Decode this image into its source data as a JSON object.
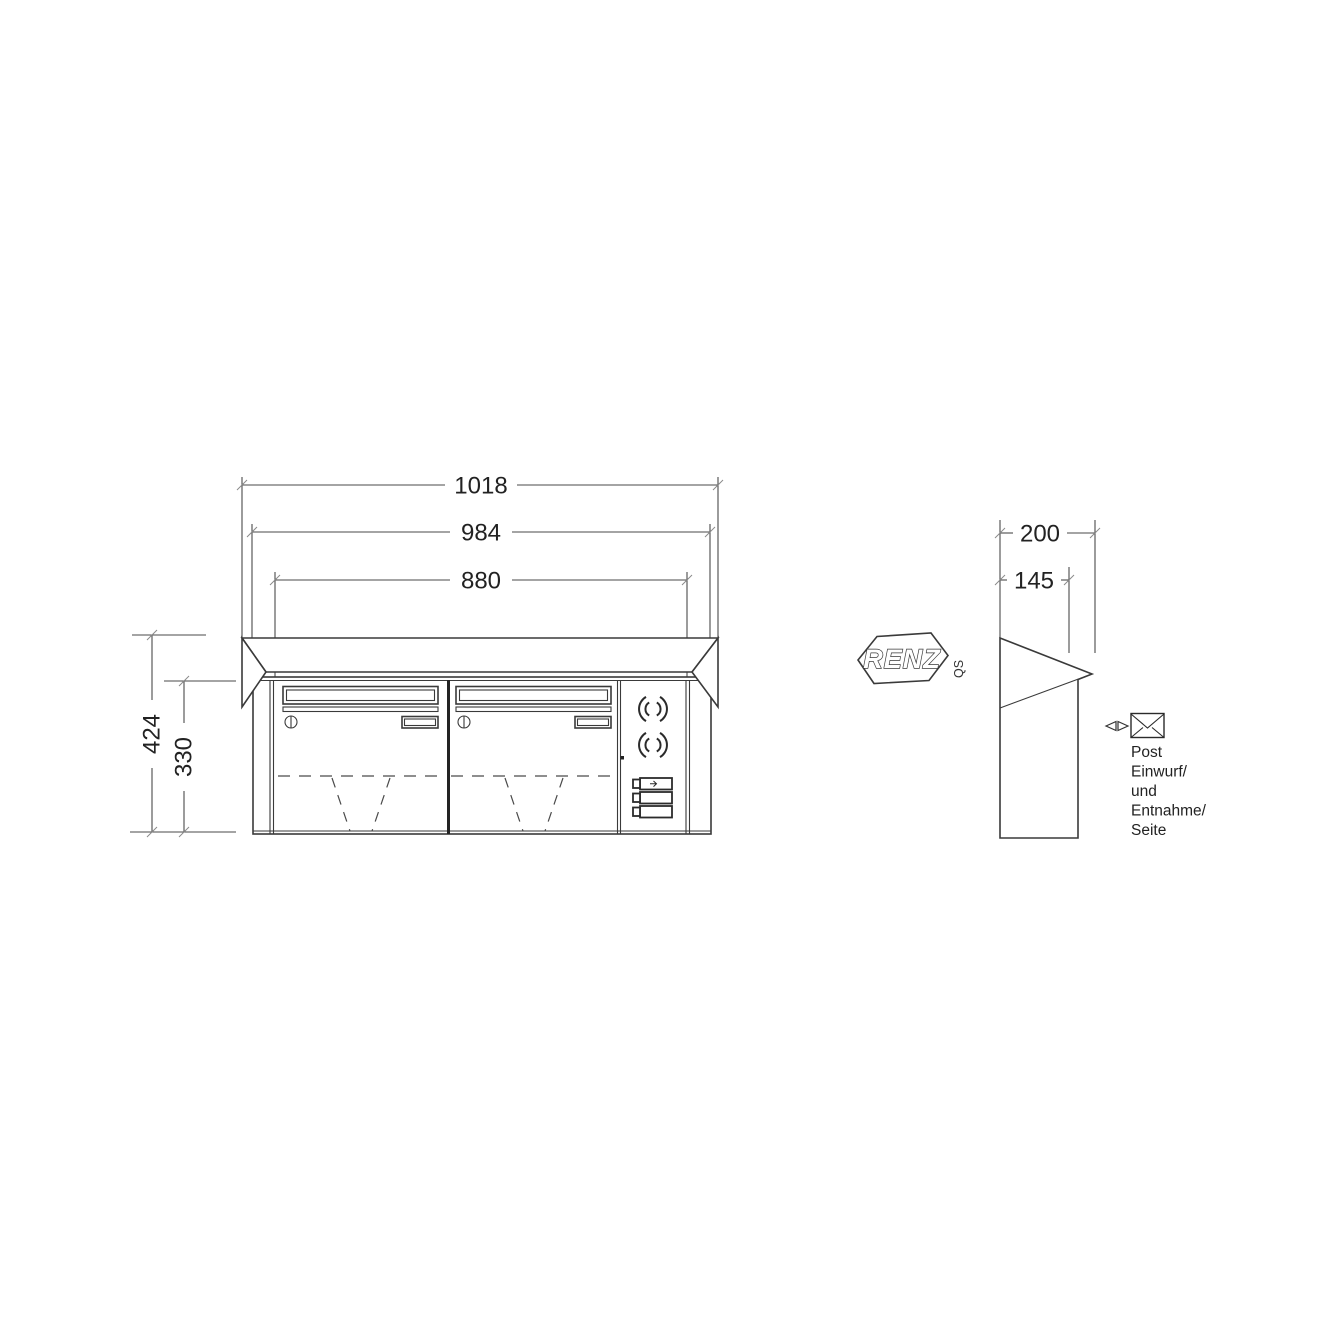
{
  "title": "RENZ letterbox technical drawing",
  "dimensions": {
    "front": {
      "hood_width": "1018",
      "body_width": "984",
      "inner_width": "880",
      "total_height": "424",
      "body_height": "330"
    },
    "side": {
      "hood_depth": "200",
      "body_depth": "145"
    }
  },
  "brand": {
    "logo": "RENZ",
    "qs": "QS"
  },
  "note": {
    "lines": [
      "Post",
      "Einwurf/",
      "und",
      "Entnahme/",
      "Seite"
    ]
  },
  "icons": {
    "envelope-icon": "✉",
    "left-right-arrows-icon": "◁▷",
    "speaker-icon": "(())",
    "lock-icon": "①",
    "bell-arrow-icon": "⇨"
  }
}
